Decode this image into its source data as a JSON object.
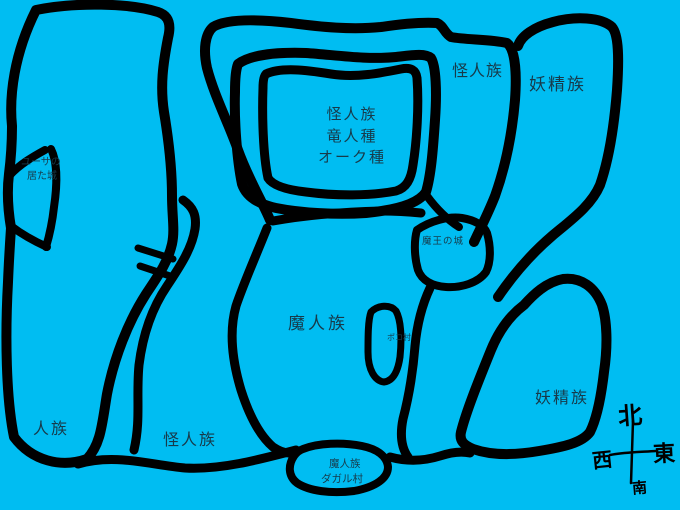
{
  "theme": {
    "background": "#00bdf2",
    "ink": "#000000",
    "label_color": "#173a4a"
  },
  "labels": {
    "ring_region": [
      "怪人族",
      "竜人種",
      "オーク種"
    ],
    "kaijin_top": "怪人族",
    "yousei_top": "妖精族",
    "yusa_castle": [
      "ユーサの",
      "居た城"
    ],
    "maou_castle": "魔王の城",
    "majin_center": "魔人族",
    "poko_village": "ポコ村",
    "yousei_bottom": "妖精族",
    "jinzoku": "人族",
    "kaijin_bottom": "怪人族",
    "dagal_village": [
      "魔人族",
      "ダガル村"
    ],
    "compass": {
      "north": "北",
      "south": "南",
      "east": "東",
      "west": "西"
    }
  }
}
